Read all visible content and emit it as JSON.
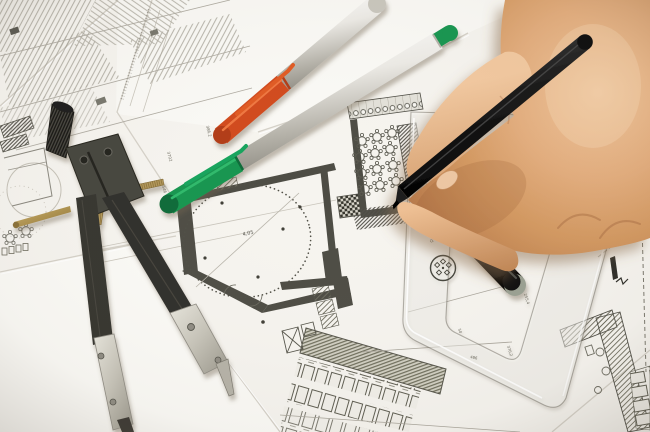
{
  "scene": {
    "alt": "Photograph: a hand drawing with a black pen on overlapping architectural floor plans, with a drafting compass, two marker pens, a black pen cap and a transparent set square"
  },
  "labels": {
    "room_dim": "4,05",
    "dim_3702": "3702",
    "dim_546": "546",
    "dim_386": "386,2",
    "dim_486": "486",
    "dim_2554": "255,4",
    "dim_3702r": "370,2",
    "dim_50": "50"
  },
  "ruler": {
    "brand": "Quattro Linien"
  },
  "colors": {
    "orange_cap": "#d14a1d",
    "orange_cap_dark": "#b23a12",
    "green_cap": "#18954f",
    "green_cap_dark": "#0d6b38",
    "plan_ink": "#4d4c44",
    "paper": "#f6f4ef",
    "skin": "#e3ad7d",
    "compass_black": "#2e2d29",
    "brass": "#a88c4a"
  }
}
